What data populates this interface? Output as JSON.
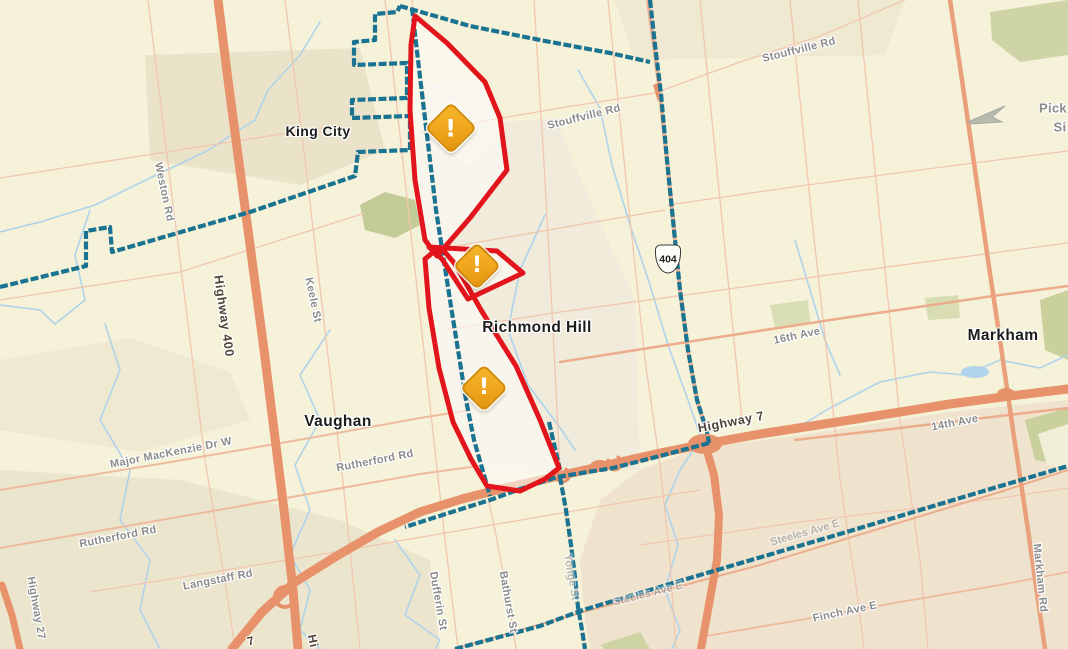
{
  "map": {
    "region_description": "outage map of York Region: King City, Richmond Hill, Vaughan, Markham",
    "cities": [
      "King City",
      "Richmond Hill",
      "Vaughan",
      "Markham"
    ],
    "outage_areas": {
      "count": 3,
      "warning_icons": [
        {
          "x": 451,
          "y": 128,
          "size": 33
        },
        {
          "x": 477,
          "y": 266,
          "size": 30
        },
        {
          "x": 484,
          "y": 388,
          "size": 30
        }
      ]
    },
    "shield": {
      "text": "404",
      "x": 668,
      "y": 259
    },
    "labels": [
      {
        "text": "King City",
        "x": 318,
        "y": 131,
        "rot": 0,
        "cls": "city",
        "fs": 14
      },
      {
        "text": "Richmond Hill",
        "x": 537,
        "y": 328,
        "rot": 0,
        "cls": "city",
        "fs": 15.5
      },
      {
        "text": "Vaughan",
        "x": 338,
        "y": 422,
        "rot": 0,
        "cls": "city",
        "fs": 15.5
      },
      {
        "text": "Markham",
        "x": 1003,
        "y": 336,
        "rot": 0,
        "cls": "city",
        "fs": 15.5
      },
      {
        "text": "Weston Rd",
        "x": 164,
        "y": 192,
        "rot": 78,
        "cls": "road"
      },
      {
        "text": "Keele St",
        "x": 313,
        "y": 300,
        "rot": 78,
        "cls": "road"
      },
      {
        "text": "Stouffville Rd",
        "x": 584,
        "y": 117,
        "rot": -14,
        "cls": "road"
      },
      {
        "text": "Stouffville Rd",
        "x": 799,
        "y": 50,
        "rot": -14,
        "cls": "road"
      },
      {
        "text": "16th Ave",
        "x": 797,
        "y": 336,
        "rot": -12,
        "cls": "road"
      },
      {
        "text": "14th Ave",
        "x": 955,
        "y": 423,
        "rot": -11,
        "cls": "road"
      },
      {
        "text": "Rutherford Rd",
        "x": 118,
        "y": 537,
        "rot": -11,
        "cls": "road"
      },
      {
        "text": "Rutherford Rd",
        "x": 375,
        "y": 461,
        "rot": -11,
        "cls": "road"
      },
      {
        "text": "Major MacKenzie Dr W",
        "x": 171,
        "y": 453,
        "rot": -11,
        "cls": "road"
      },
      {
        "text": "Langstaff Rd",
        "x": 218,
        "y": 580,
        "rot": -11,
        "cls": "road"
      },
      {
        "text": "Markham Rd",
        "x": 1040,
        "y": 578,
        "rot": 84,
        "cls": "road"
      },
      {
        "text": "Dufferin St",
        "x": 438,
        "y": 601,
        "rot": 80,
        "cls": "road"
      },
      {
        "text": "Bathurst St",
        "x": 508,
        "y": 602,
        "rot": 80,
        "cls": "road"
      },
      {
        "text": "Yonge St",
        "x": 571,
        "y": 577,
        "rot": 80,
        "cls": "road-dim"
      },
      {
        "text": "Steeles Ave E",
        "x": 648,
        "y": 594,
        "rot": -14,
        "cls": "road-dim"
      },
      {
        "text": "Steeles Ave E",
        "x": 805,
        "y": 533,
        "rot": -16,
        "cls": "road-dim"
      },
      {
        "text": "Finch Ave E",
        "x": 845,
        "y": 612,
        "rot": -12,
        "cls": "road"
      },
      {
        "text": "Highway 27",
        "x": 36,
        "y": 608,
        "rot": 80,
        "cls": "road"
      },
      {
        "text": "Pick",
        "x": 1053,
        "y": 108,
        "rot": 0,
        "cls": "road",
        "fs": 13
      },
      {
        "text": "Si",
        "x": 1060,
        "y": 127,
        "rot": 0,
        "cls": "road",
        "fs": 13
      },
      {
        "text": "Highway 400",
        "x": 224,
        "y": 316,
        "rot": 82,
        "cls": "road-dark",
        "fs": 12.5
      },
      {
        "text": "Highway 7",
        "x": 731,
        "y": 422,
        "rot": -11,
        "cls": "road-dark",
        "fs": 12.5
      },
      {
        "text": "Hi",
        "x": 313,
        "y": 641,
        "rot": 78,
        "cls": "road-dark",
        "fs": 12
      },
      {
        "text": "7",
        "x": 251,
        "y": 641,
        "rot": -15,
        "cls": "road-dark",
        "fs": 12
      }
    ],
    "colors": {
      "background": "#F5F2D9",
      "boundary_teal": "#1A7390",
      "outage_outline_red": "#E2141C",
      "warning_fill": "#EFA51D",
      "highway_orange": "#E8926B",
      "minor_road": "#F2C6AE",
      "stream_blue": "#AFD3EB",
      "label_gray": "#8B8B8B"
    }
  }
}
